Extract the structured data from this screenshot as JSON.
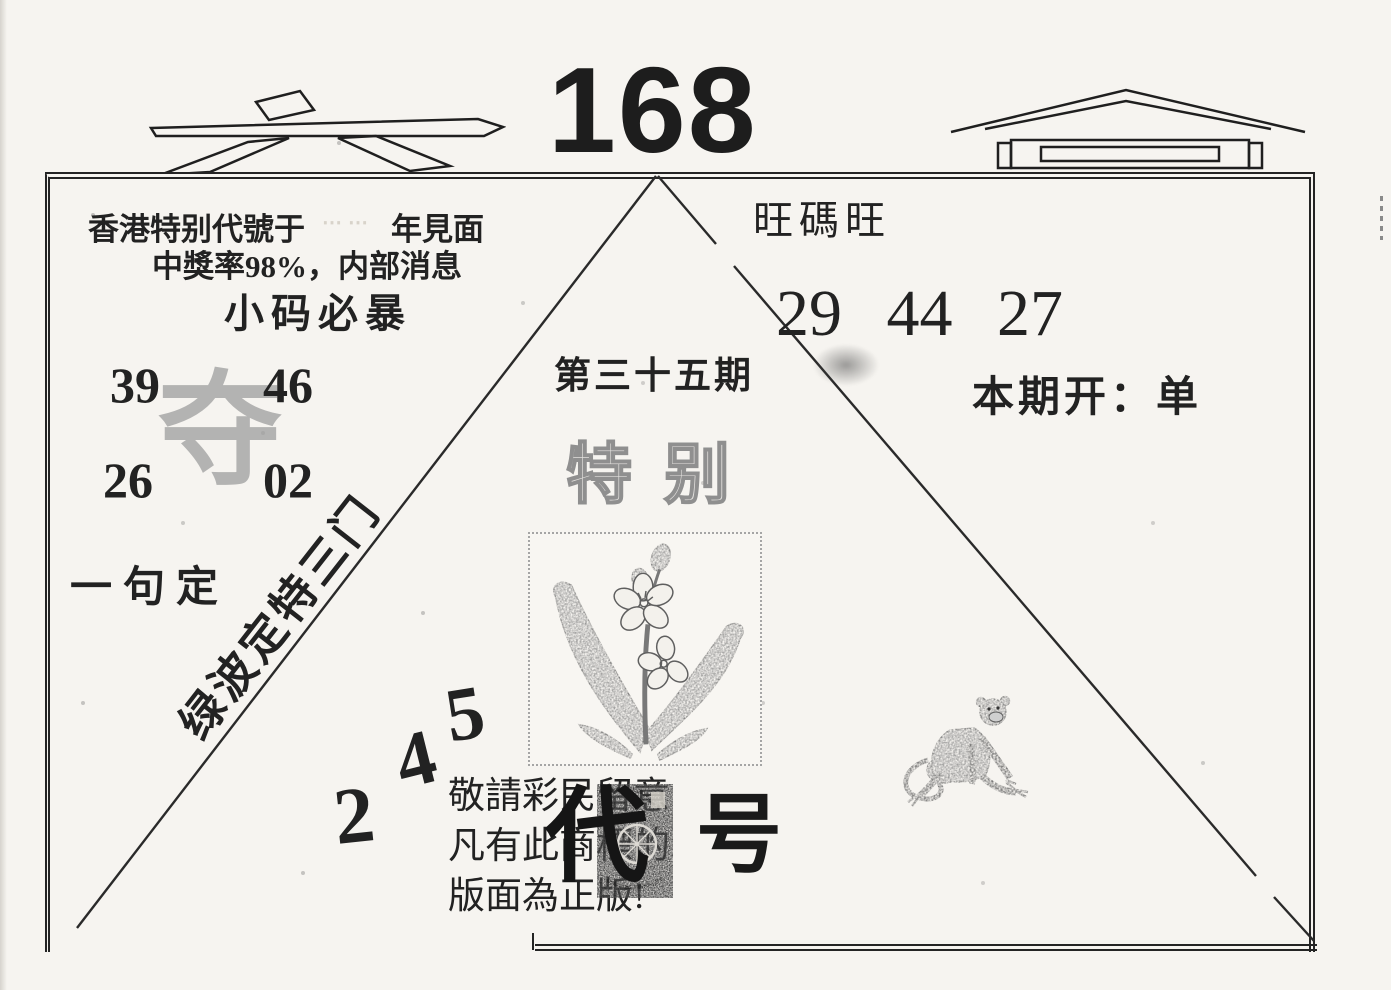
{
  "masthead": {
    "left_glyph": "六",
    "number": "168",
    "right_glyph": "合"
  },
  "intro": {
    "line1_prefix": "香港特别代號于",
    "line1_suffix": "年見面",
    "line2": "中獎率98%，内部消息",
    "headline": "小码必暴"
  },
  "corner_numbers": {
    "top_left": "39",
    "top_right": "46",
    "bottom_left": "26",
    "bottom_right": "02",
    "overlay_char": "夺"
  },
  "slogans": {
    "phrase": "一句定",
    "diagonal": "绿波定特三门"
  },
  "issue": {
    "title": "第三十五期",
    "special": "特别"
  },
  "right_panel": {
    "wang": "旺碼旺",
    "numbers": "29 44 27",
    "result_label": "本期开：",
    "result_value": "单"
  },
  "stair_numbers": [
    "2",
    "4",
    "5"
  ],
  "notice": {
    "line1": "敬請彩民留意",
    "line2": "凡有此商標的",
    "line3": "版面為正版!",
    "code_left": "代",
    "code_right": "号"
  },
  "images": {
    "flower": "plum-blossom-illustration",
    "monkey": "monkey-illustration",
    "stamp": "trademark-stamp"
  },
  "colors": {
    "ink": "#222222",
    "paper": "#f6f4f0",
    "faded_gray": "#9e9e9e"
  }
}
